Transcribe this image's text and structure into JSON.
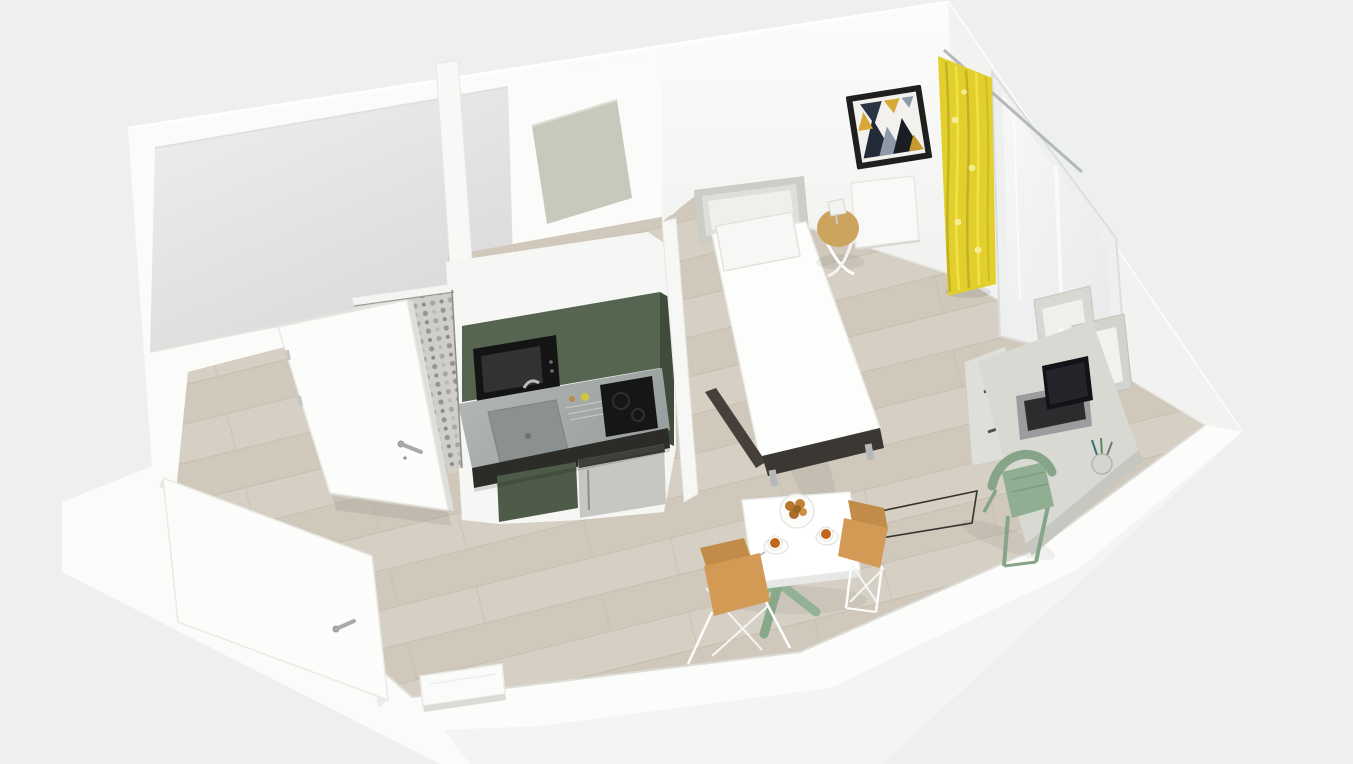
{
  "scene": {
    "kind": "3d-studio-apartment-floorplan-render",
    "description": "Cutaway dollhouse view of a furnished studio apartment seen from above",
    "background": "#eef0ef",
    "labels": {
      "tv_zone": "TV"
    },
    "palette": {
      "wall_white": "#fbfbfa",
      "wall_shade": "#f2f2f0",
      "floor_wood": "#d3ccc0",
      "floor_seam": "#c2b9aa",
      "bathroom_floor": "#e6e7e6",
      "tile_base": "#cfcecb",
      "tile_dot": "#96958f",
      "cabinet_green": "#55654f",
      "cabinet_green_dark": "#3f4c3b",
      "cabinet_green_door": "#4d5b48",
      "counter_steel": "#a9adac",
      "counter_dark": "#2b2b28",
      "appliance_black": "#141414",
      "fridge_steel": "#c6c7c3",
      "bed_white": "#fdfdfc",
      "headboard_gray": "#cbcdc6",
      "bed_base_dark": "#3b3733",
      "curtain_yellow": "#e2cf2d",
      "art_navy": "#232b38",
      "art_gold": "#d7a737",
      "desk_gray": "#d9d9d3",
      "chair_sage": "#8fae92",
      "chair_tan": "#d39a55",
      "chair_tan_dark": "#c08c47",
      "table_white": "#ffffff",
      "pedestal_sage": "#93b295",
      "side_table_wood": "#cda45e",
      "coffee_orange": "#c2661c",
      "cookie_brown": "#b5772f",
      "metal_silver": "#b5b8b9",
      "wardrobe_beige": "#c9c8bc"
    },
    "objects": [
      {
        "id": "bathroom",
        "desc": "enclosed room at top-left"
      },
      {
        "id": "bathroom-door",
        "desc": "white door ajar over patterned tile threshold"
      },
      {
        "id": "entrance-door",
        "desc": "white entrance door swung open"
      },
      {
        "id": "kitchenette",
        "desc": "compact green kitchen with microwave, sink, cooktop, mini fridge"
      },
      {
        "id": "wardrobe",
        "desc": "tall beige cabinet in niche"
      },
      {
        "id": "single-bed",
        "desc": "white single bed, grey headboard, dark base, chrome feet"
      },
      {
        "id": "bedside-table",
        "desc": "round wood-top wire table with lamp"
      },
      {
        "id": "wall-art",
        "desc": "framed geometric triangle print"
      },
      {
        "id": "radiator",
        "desc": "white wall radiator panels"
      },
      {
        "id": "window",
        "desc": "tall window with yellow curtain"
      },
      {
        "id": "desk",
        "desc": "grey desk with drawers, laptop, pen cup, cube shelves"
      },
      {
        "id": "desk-chair",
        "desc": "sage green chair"
      },
      {
        "id": "dining-table",
        "desc": "white table, sage pedestal, cookie plate, two coffees"
      },
      {
        "id": "dining-chairs",
        "desc": "two tan shell chairs on white wire legs"
      },
      {
        "id": "tv-zone",
        "desc": "thin outlined floor rectangle labelled TV"
      }
    ]
  }
}
